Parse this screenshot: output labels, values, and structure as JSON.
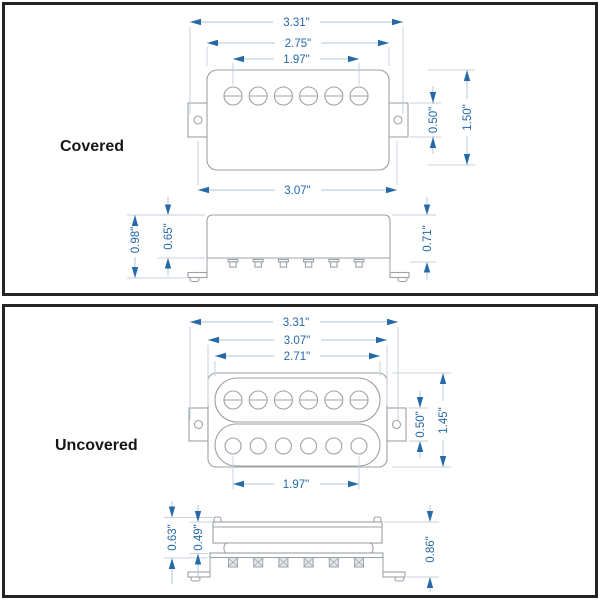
{
  "covered": {
    "label": "Covered",
    "top": {
      "mount_hole_span": "3.31\"",
      "cover_width": "2.75\"",
      "pole_span": "1.97\"",
      "base_width": "3.07\"",
      "ear_height": "0.50\"",
      "body_height": "1.50\""
    },
    "side": {
      "overall_height": "0.98\"",
      "cover_height": "0.65\"",
      "right_height": "0.71\""
    }
  },
  "uncovered": {
    "label": "Uncovered",
    "top": {
      "mount_hole_span": "3.31\"",
      "base_width": "3.07\"",
      "bobbin_width": "2.71\"",
      "pole_span": "1.97\"",
      "ear_height": "0.50\"",
      "body_height": "1.45\""
    },
    "side": {
      "left_outer_height": "0.63\"",
      "bobbin_height": "0.49\"",
      "overall_height": "0.86\""
    }
  },
  "colors": {
    "dimension_blue": "#2569a8",
    "dimension_line": "#b6c5d6",
    "extension_line": "#c7d2de",
    "drawing_gray": "#9ca1a6",
    "panel_border": "#242424"
  }
}
